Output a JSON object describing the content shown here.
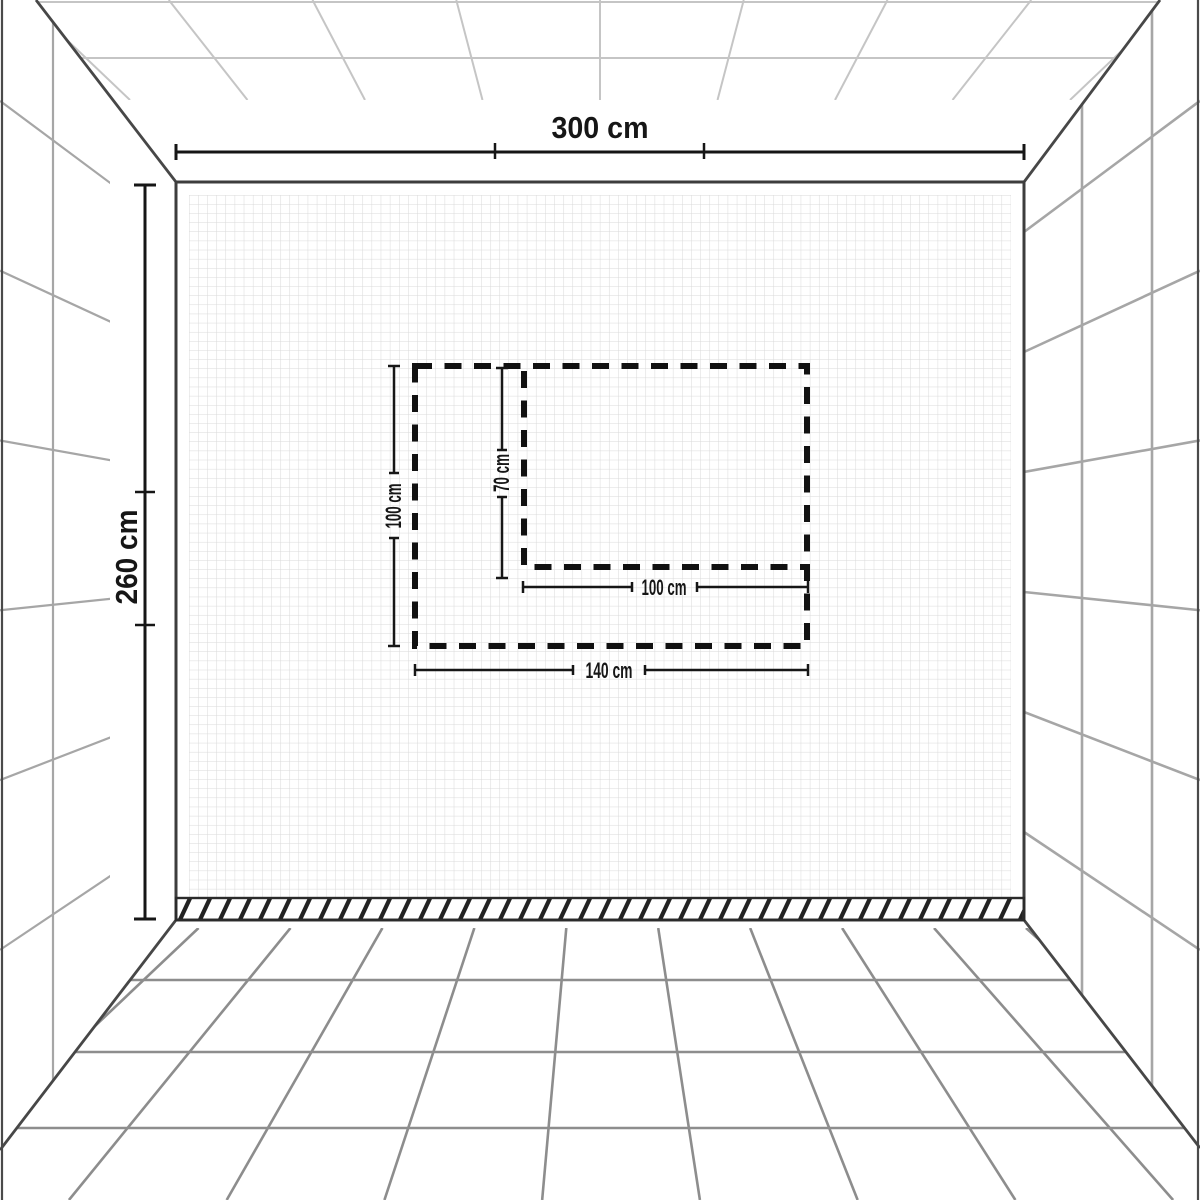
{
  "diagram": {
    "type": "room-perspective-measurement-diagram",
    "labels": {
      "room_width": "300 cm",
      "room_height": "260 cm",
      "area_width": "140 cm",
      "area_height": "100 cm",
      "inner_width": "100 cm",
      "inner_height": "70 cm"
    },
    "measurements": {
      "room_width_cm": 300,
      "room_height_cm": 260,
      "marked_area": {
        "width_cm": 140,
        "height_cm": 100
      },
      "inner_area": {
        "width_cm": 100,
        "height_cm": 70
      }
    },
    "colors": {
      "ink": "#161616",
      "edge": "#474747",
      "wallborder": "#3d3d3d",
      "gridfloor": "#8d8d8d",
      "gridceiling": "#c5c5c5",
      "gridwall": "#a6a6a6",
      "mosaic": "#d9d9d9",
      "hatch": "#222222",
      "bg": "#ffffff"
    }
  }
}
